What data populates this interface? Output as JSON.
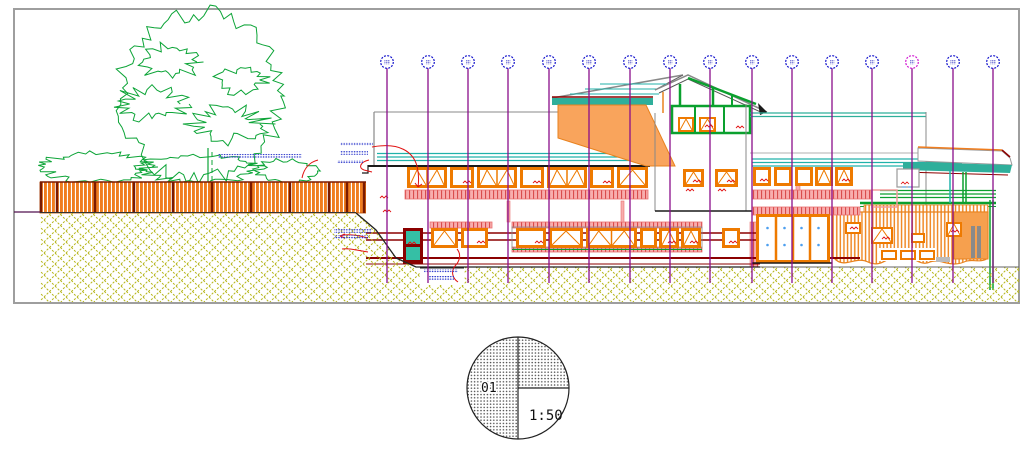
{
  "title_block": {
    "detail_number": "01",
    "scale_label": "1:50"
  },
  "drawing": {
    "type": "building-elevation-section",
    "grid_axis_count": 16
  },
  "colors": {
    "border_gray": "#9E9E9E",
    "tree_green": "#0CA437",
    "frame_green": "#0AA02E",
    "fence_orange": "#F07D1E",
    "window_frame_orange": "#EE7A00",
    "gable_orange": "#F9A45C",
    "wing_orange": "#F6A04E",
    "ground_olive": "#B5B517",
    "roof_teal": "#20B2AA",
    "band_teal": "#2FAF9B",
    "grid_purple": "#8A0E8A",
    "bubble_blue": "#1414CC",
    "bubble_highlight_magenta": "#D119D1",
    "slab_pink": "#F8ADAD",
    "slab_pink_hatch": "#D94C4C",
    "dark_red": "#8B0000",
    "leader_red": "#E11212",
    "annotation_blue": "#2430C9",
    "glass_teal": "#35BFA5",
    "door_glass_blue": "#4D9FEF"
  },
  "grid": {
    "x_positions": [
      387,
      428,
      468,
      508,
      549,
      589,
      630,
      670,
      710,
      752,
      792,
      832,
      872,
      912,
      953,
      993
    ],
    "bubble_cy": 62,
    "bubble_r": 6.3,
    "line_top": 68,
    "line_bottom": 283,
    "highlight_index": 13
  },
  "fence": {
    "x": 40,
    "y": 182,
    "w": 326,
    "h": 31,
    "posts": [
      41,
      57,
      95,
      134,
      173,
      212,
      251,
      290,
      329,
      347,
      364
    ]
  },
  "window_rows": [
    {
      "name": "upper-left",
      "y": 167,
      "h": 21,
      "items": [
        {
          "x": 407,
          "w": 40,
          "t": "tri2"
        },
        {
          "x": 450,
          "w": 24,
          "t": "plain",
          "m": 1
        },
        {
          "x": 477,
          "w": 40,
          "t": "tri2"
        },
        {
          "x": 520,
          "w": 24,
          "t": "plain",
          "m": 1
        },
        {
          "x": 547,
          "w": 40,
          "t": "tri2"
        },
        {
          "x": 590,
          "w": 24,
          "t": "plain",
          "m": 1
        },
        {
          "x": 617,
          "w": 31,
          "t": "tri"
        }
      ]
    },
    {
      "name": "upper-right",
      "y": 167,
      "h": 19,
      "items": [
        {
          "x": 753,
          "w": 18,
          "t": "plain",
          "m": 1
        },
        {
          "x": 774,
          "w": 18,
          "t": "plain"
        },
        {
          "x": 795,
          "w": 18,
          "t": "plain"
        },
        {
          "x": 815,
          "w": 18,
          "t": "tri"
        },
        {
          "x": 835,
          "w": 18,
          "t": "tri",
          "m": 1
        }
      ]
    },
    {
      "name": "tower",
      "y": 169,
      "h": 18,
      "items": [
        {
          "x": 683,
          "w": 21,
          "t": "tri",
          "m": 1
        },
        {
          "x": 715,
          "w": 23,
          "t": "tri",
          "m": 1
        }
      ]
    },
    {
      "name": "gable",
      "y": 117,
      "h": 15,
      "items": [
        {
          "x": 678,
          "w": 16,
          "t": "tri"
        },
        {
          "x": 699,
          "w": 17,
          "t": "tri",
          "m": 1
        }
      ]
    },
    {
      "name": "lower",
      "y": 228,
      "h": 20,
      "items": [
        {
          "x": 431,
          "w": 27,
          "t": "tri"
        },
        {
          "x": 461,
          "w": 27,
          "t": "plain",
          "m": 1
        },
        {
          "x": 516,
          "w": 30,
          "t": "plain",
          "m": 1
        },
        {
          "x": 549,
          "w": 34,
          "t": "tri"
        },
        {
          "x": 586,
          "w": 51,
          "t": "tri2"
        },
        {
          "x": 640,
          "w": 17,
          "t": "plain"
        },
        {
          "x": 659,
          "w": 20,
          "t": "tri",
          "m": 1
        },
        {
          "x": 681,
          "w": 20,
          "t": "tri",
          "m": 1
        },
        {
          "x": 722,
          "w": 18,
          "t": "plain",
          "m": 1
        }
      ]
    },
    {
      "name": "wing",
      "items": [
        {
          "x": 845,
          "y": 222,
          "w": 16,
          "h": 12,
          "t": "plain",
          "m": 1
        },
        {
          "x": 871,
          "y": 227,
          "w": 22,
          "h": 17,
          "t": "tri",
          "m": 1
        },
        {
          "x": 911,
          "y": 233,
          "w": 14,
          "h": 10,
          "t": "plain"
        },
        {
          "x": 946,
          "y": 222,
          "w": 16,
          "h": 15,
          "t": "tri",
          "m": 1
        }
      ]
    },
    {
      "name": "wing-base",
      "items": [
        {
          "x": 881,
          "y": 250,
          "w": 16,
          "h": 10,
          "t": "plain"
        },
        {
          "x": 900,
          "y": 250,
          "w": 16,
          "h": 10,
          "t": "plain"
        },
        {
          "x": 919,
          "y": 250,
          "w": 16,
          "h": 10,
          "t": "plain"
        }
      ]
    }
  ],
  "door": {
    "x": 756,
    "y": 214,
    "w": 74,
    "h": 49,
    "panels": 4
  },
  "annotation_blocks": [
    {
      "x": 340,
      "y": 142,
      "step": 9,
      "rows": [
        {
          "dx": 0,
          "w": 33
        },
        {
          "dx": 0,
          "w": 28
        },
        {
          "dx": -3,
          "w": 26
        }
      ]
    },
    {
      "x": 334,
      "y": 229,
      "step": 6,
      "rows": [
        {
          "dx": 0,
          "w": 38
        },
        {
          "dx": 0,
          "w": 34
        }
      ]
    },
    {
      "x": 424,
      "y": 269,
      "step": 7,
      "rows": [
        {
          "dx": 0,
          "w": 34
        },
        {
          "dx": 4,
          "w": 26
        }
      ]
    },
    {
      "x": 218,
      "y": 154,
      "step": 0,
      "rows": [
        {
          "dx": 0,
          "w": 84
        }
      ]
    }
  ]
}
